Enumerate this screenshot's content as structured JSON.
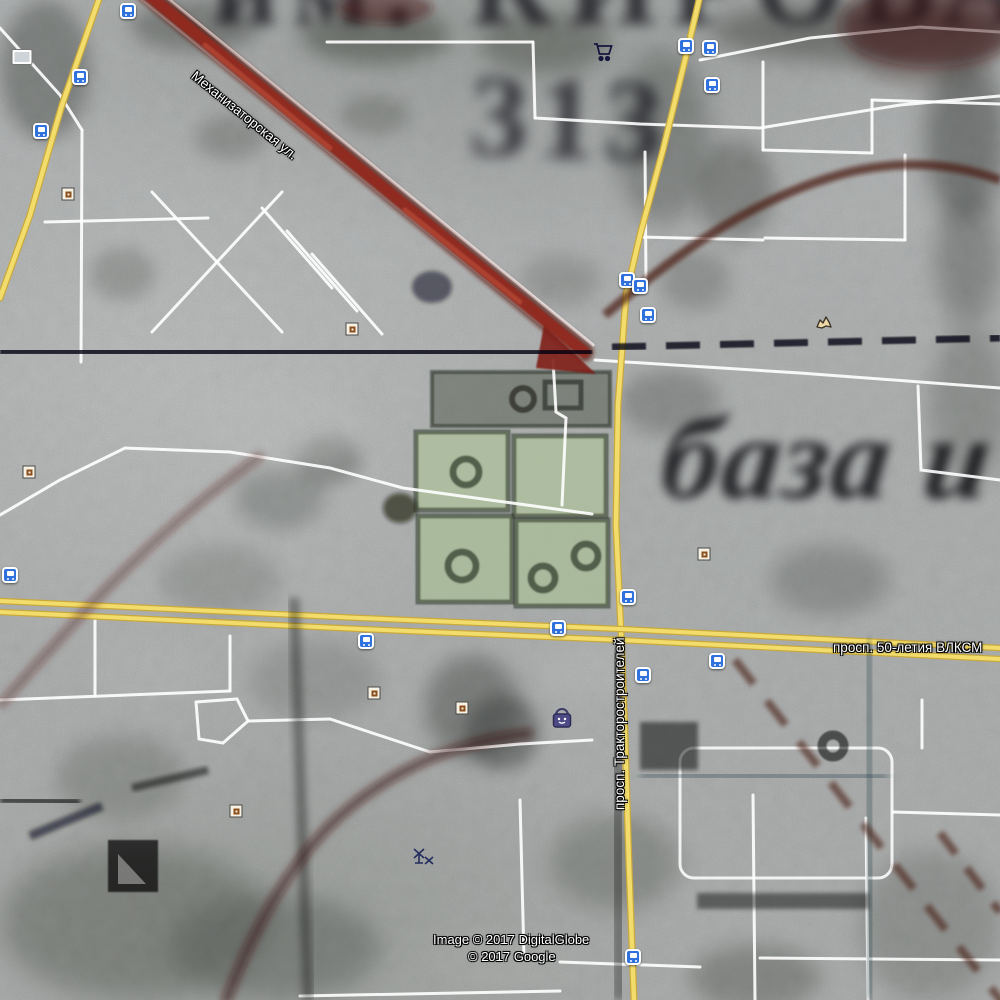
{
  "map": {
    "street_labels": {
      "diagonal": "Механизаторская ул.",
      "vertical": "просп. Тракторостроителей",
      "horizontal": "просп. 50-летия ВЛКСМ"
    },
    "historic_overlay": {
      "top_text": "им. КИРОВА",
      "block_number": "313",
      "script_text": "база и"
    },
    "attribution": {
      "line1": "Image © 2017 DigitalGlobe",
      "line2": "© 2017 Google"
    },
    "colors": {
      "road_yellow": "#f2dc6b",
      "road_yellow_casing": "#c9a93c",
      "road_white": "#ffffff",
      "historic_red_road": "#93271d",
      "historic_ink": "#0e0e16",
      "transit_blue": "#2f72dd",
      "poi_beige": "#f8f2e4",
      "park_green": "#afc09e"
    },
    "icons": [
      {
        "name": "transit-stop-icon",
        "type": "transit",
        "x": 128,
        "y": 11
      },
      {
        "name": "transit-stop-icon",
        "type": "transit",
        "x": 80,
        "y": 77
      },
      {
        "name": "transit-stop-icon",
        "type": "transit",
        "x": 41,
        "y": 131
      },
      {
        "name": "transit-stop-icon",
        "type": "transit",
        "x": 686,
        "y": 46
      },
      {
        "name": "transit-stop-icon",
        "type": "transit",
        "x": 710,
        "y": 48
      },
      {
        "name": "transit-stop-icon",
        "type": "transit",
        "x": 712,
        "y": 85
      },
      {
        "name": "transit-stop-icon",
        "type": "transit",
        "x": 627,
        "y": 280
      },
      {
        "name": "transit-stop-icon",
        "type": "transit",
        "x": 640,
        "y": 286
      },
      {
        "name": "transit-stop-icon",
        "type": "transit",
        "x": 648,
        "y": 315
      },
      {
        "name": "transit-stop-icon",
        "type": "transit",
        "x": 10,
        "y": 575
      },
      {
        "name": "transit-stop-icon",
        "type": "transit",
        "x": 558,
        "y": 628
      },
      {
        "name": "transit-stop-icon",
        "type": "transit",
        "x": 366,
        "y": 641
      },
      {
        "name": "transit-stop-icon",
        "type": "transit",
        "x": 717,
        "y": 661
      },
      {
        "name": "transit-stop-icon",
        "type": "transit",
        "x": 643,
        "y": 675
      },
      {
        "name": "transit-stop-icon",
        "type": "transit",
        "x": 628,
        "y": 597
      },
      {
        "name": "transit-stop-icon",
        "type": "transit",
        "x": 633,
        "y": 957
      },
      {
        "name": "poi-marker-icon",
        "type": "poi",
        "x": 68,
        "y": 194
      },
      {
        "name": "poi-marker-icon",
        "type": "poi",
        "x": 352,
        "y": 329
      },
      {
        "name": "poi-marker-icon",
        "type": "poi",
        "x": 29,
        "y": 472
      },
      {
        "name": "poi-marker-icon",
        "type": "poi",
        "x": 704,
        "y": 554
      },
      {
        "name": "poi-marker-icon",
        "type": "poi",
        "x": 374,
        "y": 693
      },
      {
        "name": "poi-marker-icon",
        "type": "poi",
        "x": 462,
        "y": 708
      },
      {
        "name": "poi-marker-icon",
        "type": "poi",
        "x": 236,
        "y": 811
      },
      {
        "name": "shopping-cart-icon",
        "type": "cart",
        "x": 603,
        "y": 52
      },
      {
        "name": "shopping-bag-icon",
        "type": "bag",
        "x": 562,
        "y": 718
      },
      {
        "name": "photo-icon",
        "type": "photo",
        "x": 22,
        "y": 57
      },
      {
        "name": "helicopter-icon",
        "type": "heli",
        "x": 424,
        "y": 857
      },
      {
        "name": "animal-icon",
        "type": "animal",
        "x": 824,
        "y": 322
      }
    ]
  }
}
